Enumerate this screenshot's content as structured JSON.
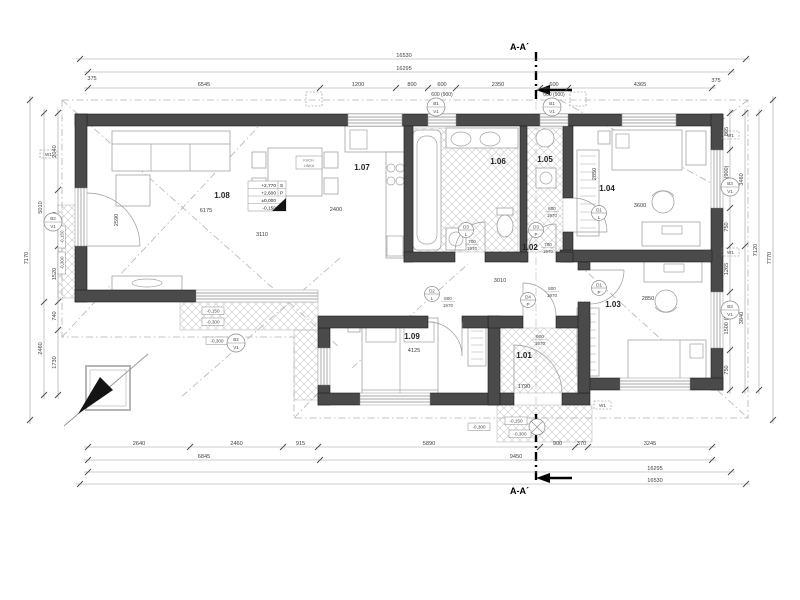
{
  "drawing": {
    "section_label": "A-A´",
    "level_marker": {
      "r1": "+2,770",
      "r1t": "S",
      "r2": "+2,600",
      "r2t": "P",
      "r3": "±0,000",
      "r4": "-0,150"
    },
    "kitchen_note": {
      "l1": "KUCH.",
      "l2": "LINKA"
    }
  },
  "rooms": [
    {
      "id": "1.08",
      "x": 222,
      "y": 198
    },
    {
      "id": "1.07",
      "x": 362,
      "y": 170
    },
    {
      "id": "1.06",
      "x": 498,
      "y": 164
    },
    {
      "id": "1.05",
      "x": 545,
      "y": 162
    },
    {
      "id": "1.04",
      "x": 607,
      "y": 191
    },
    {
      "id": "1.02",
      "x": 530,
      "y": 250
    },
    {
      "id": "1.03",
      "x": 613,
      "y": 307
    },
    {
      "id": "1.09",
      "x": 412,
      "y": 339
    },
    {
      "id": "1.01",
      "x": 524,
      "y": 358
    }
  ],
  "dims": {
    "chains": [
      {
        "o": "h",
        "pos": 59,
        "from": 80,
        "to": 746,
        "labels": [
          {
            "at": 404,
            "t": "16530"
          }
        ]
      },
      {
        "o": "h",
        "pos": 72,
        "from": 88,
        "to": 731,
        "labels": [
          {
            "at": 404,
            "t": "16295"
          }
        ]
      },
      {
        "o": "h",
        "pos": 88,
        "from": 88,
        "to": 712,
        "bounds": [
          88,
          320,
          396,
          428,
          456,
          540,
          568,
          712
        ],
        "segs": [
          "6545",
          "1200",
          "800",
          "600",
          "2350",
          "600",
          "4365"
        ],
        "subs": [
          {
            "at": 442,
            "t": "600 (900)"
          },
          {
            "at": 554,
            "t": "600 (900)"
          }
        ]
      },
      {
        "o": "h",
        "pos": 447,
        "from": 88,
        "to": 712,
        "bounds": [
          88,
          190,
          283,
          318,
          540,
          575,
          588,
          712
        ],
        "segs": [
          "2640",
          "2460",
          "915",
          "5890",
          "900",
          "370",
          "3245"
        ]
      },
      {
        "o": "h",
        "pos": 460,
        "from": 88,
        "to": 712,
        "bounds": [
          88,
          320,
          712
        ],
        "segs": [
          "6845",
          "9450"
        ]
      },
      {
        "o": "h",
        "pos": 472,
        "from": 88,
        "to": 731,
        "labels": [
          {
            "at": 655,
            "t": "16295"
          }
        ]
      },
      {
        "o": "h",
        "pos": 484,
        "from": 80,
        "to": 746,
        "labels": [
          {
            "at": 655,
            "t": "16530"
          }
        ]
      },
      {
        "o": "v",
        "pos": 58,
        "from": 113,
        "to": 395,
        "bounds": [
          113,
          190,
          246,
          302,
          330,
          395
        ],
        "segs": [
          "2040",
          "1460",
          "1520",
          "740",
          "1730"
        ]
      },
      {
        "o": "v",
        "pos": 44,
        "from": 113,
        "to": 395,
        "bounds": [
          113,
          302,
          395
        ],
        "segs": [
          "5010",
          "2460"
        ]
      },
      {
        "o": "v",
        "pos": 30,
        "from": 100,
        "to": 420,
        "labels": [
          {
            "at": 258,
            "t": "7170"
          }
        ]
      },
      {
        "o": "v",
        "pos": 730,
        "from": 113,
        "to": 390,
        "bounds": [
          113,
          150,
          208,
          246,
          292,
          350,
          390
        ],
        "segs": [
          "865",
          "1500 (900)",
          "750",
          "1265",
          "1500 (900)",
          "750"
        ]
      },
      {
        "o": "v",
        "pos": 745,
        "from": 113,
        "to": 390,
        "bounds": [
          113,
          246,
          390
        ],
        "segs": [
          "3460",
          "3840"
        ]
      },
      {
        "o": "v",
        "pos": 759,
        "from": 113,
        "to": 390,
        "labels": [
          {
            "at": 250,
            "t": "7120"
          }
        ]
      },
      {
        "o": "v",
        "pos": 773,
        "from": 100,
        "to": 420,
        "labels": [
          {
            "at": 258,
            "t": "7770"
          }
        ]
      }
    ]
  },
  "tags": {
    "window_boxes": [
      {
        "x": 40,
        "y": 150,
        "t": "W1"
      },
      {
        "x": 722,
        "y": 131,
        "t": "W1"
      },
      {
        "x": 722,
        "y": 248,
        "t": "W1"
      },
      {
        "x": 594,
        "y": 401,
        "t": "W1"
      }
    ],
    "boxed_labels": [
      {
        "x": 202,
        "y": 307,
        "t": "-0,150"
      },
      {
        "x": 202,
        "y": 318,
        "t": "-0,300"
      },
      {
        "x": 206,
        "y": 337,
        "t": "-0,300"
      },
      {
        "x": 468,
        "y": 423,
        "t": "-0,300"
      },
      {
        "x": 505,
        "y": 417,
        "t": "-0,150"
      },
      {
        "x": 509,
        "y": 430,
        "t": "-0,300"
      },
      {
        "x": 58,
        "y": 248,
        "t": "-0,150",
        "rot": 1
      },
      {
        "x": 58,
        "y": 274,
        "t": "-0,300",
        "rot": 1
      }
    ],
    "circle_tags": [
      {
        "x": 436,
        "y": 107,
        "a": "B1",
        "b": "V1"
      },
      {
        "x": 552,
        "y": 107,
        "a": "B1",
        "b": "V1"
      },
      {
        "x": 53,
        "y": 222,
        "a": "B2",
        "b": "V1"
      },
      {
        "x": 730,
        "y": 187,
        "a": "B3",
        "b": "V1"
      },
      {
        "x": 730,
        "y": 310,
        "a": "B3",
        "b": "V1"
      },
      {
        "x": 236,
        "y": 343,
        "a": "B2",
        "b": "V1"
      }
    ],
    "door_tags": [
      {
        "x": 599,
        "y": 213,
        "a": "D1",
        "b": "L"
      },
      {
        "x": 599,
        "y": 288,
        "a": "D1",
        "b": "P"
      },
      {
        "x": 432,
        "y": 294,
        "a": "D2",
        "b": "L"
      },
      {
        "x": 466,
        "y": 230,
        "a": "D3",
        "b": "L"
      },
      {
        "x": 536,
        "y": 230,
        "a": "D3",
        "b": "P"
      },
      {
        "x": 528,
        "y": 300,
        "a": "D4",
        "b": "P"
      }
    ],
    "door_sizes": [
      {
        "x": 552,
        "y": 210,
        "a": "800",
        "b": "1970"
      },
      {
        "x": 552,
        "y": 290,
        "a": "800",
        "b": "1970"
      },
      {
        "x": 448,
        "y": 300,
        "a": "800",
        "b": "1970"
      },
      {
        "x": 472,
        "y": 243,
        "a": "700",
        "b": "1970"
      },
      {
        "x": 548,
        "y": 246,
        "a": "700",
        "b": "1970"
      },
      {
        "x": 540,
        "y": 338,
        "a": "900",
        "b": "1970"
      }
    ],
    "free_texts": [
      {
        "x": 206,
        "y": 212,
        "t": "6175"
      },
      {
        "x": 262,
        "y": 236,
        "t": "3110"
      },
      {
        "x": 118,
        "y": 220,
        "t": "2590",
        "rot": 1
      },
      {
        "x": 336,
        "y": 211,
        "t": "2400"
      },
      {
        "x": 500,
        "y": 282,
        "t": "3010"
      },
      {
        "x": 640,
        "y": 207,
        "t": "3600"
      },
      {
        "x": 596,
        "y": 174,
        "t": "2850",
        "rot": 1
      },
      {
        "x": 648,
        "y": 300,
        "t": "2850"
      },
      {
        "x": 414,
        "y": 352,
        "t": "4125"
      },
      {
        "x": 524,
        "y": 388,
        "t": "1790"
      },
      {
        "x": 92,
        "y": 80,
        "t": "375"
      },
      {
        "x": 716,
        "y": 82,
        "t": "375"
      }
    ]
  }
}
